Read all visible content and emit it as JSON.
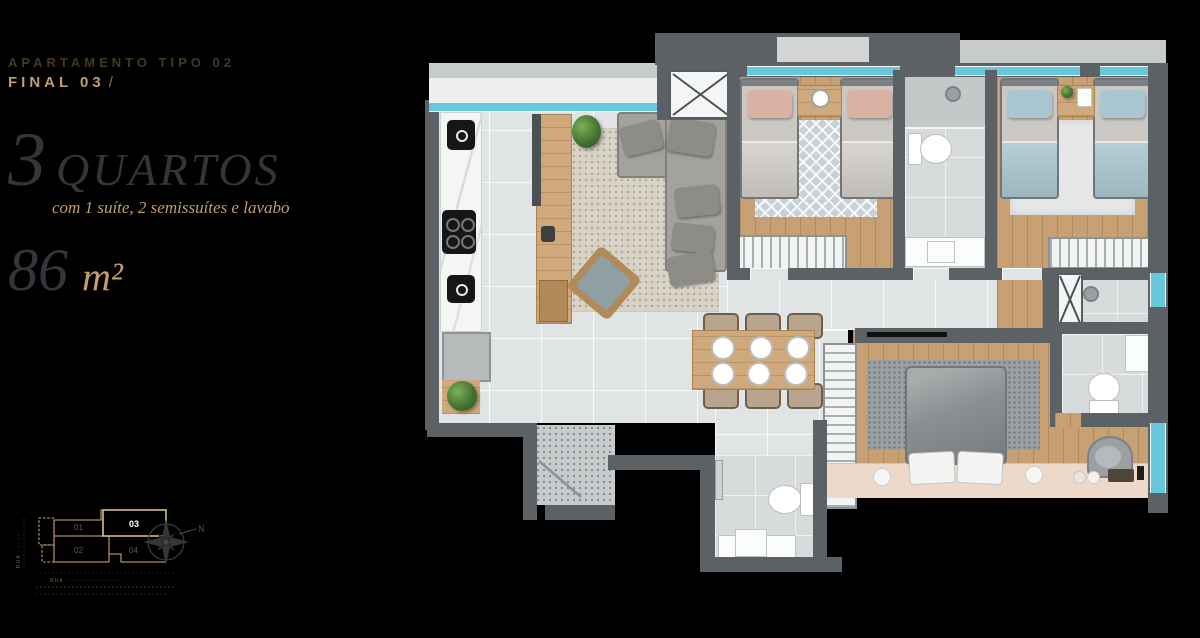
{
  "header": {
    "project_label": "APARTAMENTO TIPO 02",
    "unit_label": "FINAL 03",
    "unit_suffix": "/"
  },
  "specs": {
    "rooms_number": "3",
    "rooms_word": "QUARTOS",
    "rooms_detail": "com 1 suíte, 2 semissuítes e lavabo",
    "area_value": "86",
    "area_unit": "m²"
  },
  "key_plan": {
    "units": [
      {
        "id": "01",
        "highlighted": false
      },
      {
        "id": "02",
        "highlighted": false
      },
      {
        "id": "03",
        "highlighted": true
      },
      {
        "id": "04",
        "highlighted": false
      }
    ],
    "street_label_bottom": "RUA ·····················",
    "street_label_left": "RUA ········",
    "compass_label": "N"
  },
  "colors": {
    "background": "#000000",
    "accent_gold": "#c49d6e",
    "muted_bronze": "#453823",
    "heading_gray": "#34353a",
    "wall_gray": "#5b6164",
    "floor_tile": "#e1e4e5",
    "floor_wood": "#c7a074",
    "window_glass": "#68c8db",
    "keyplan_outline": "#a98e58"
  }
}
